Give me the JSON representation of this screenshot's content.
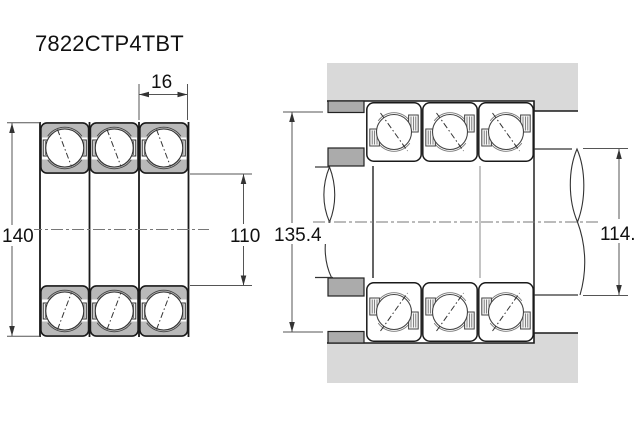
{
  "title": "7822CTP4TBT",
  "views": {
    "left": {
      "name": "bearing set cross-section (triplex TBT)"
    },
    "right": {
      "name": "mounted arrangement with housing, spacers and shaft"
    }
  },
  "dims": {
    "od": "140",
    "bore": "110",
    "width": "16",
    "spacer_id": "135.4",
    "shaft_dia": "114."
  },
  "colors": {
    "bearing_fill": "#b9b9b9",
    "housing_fill": "#d9d9d9",
    "spacer_fill": "#ababab",
    "line": "#1a1a1a",
    "thin": "#555555"
  }
}
